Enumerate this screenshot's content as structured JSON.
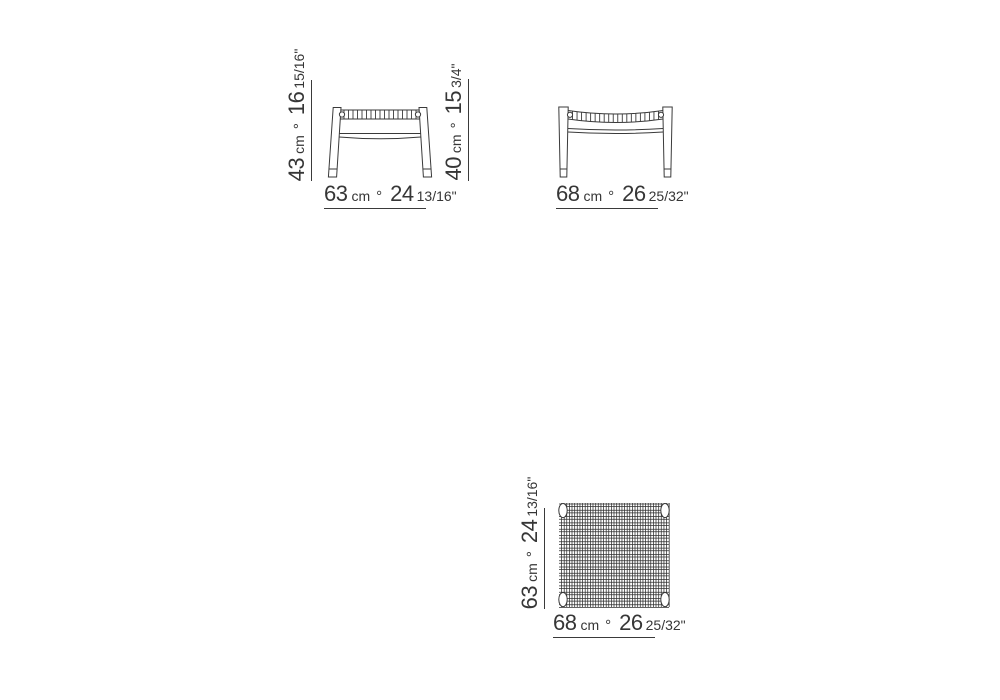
{
  "title": "stool-dimension-diagram",
  "unit": "cm",
  "sep": "°",
  "colors": {
    "line": "#3a3a3a",
    "text": "#363636",
    "background": "#ffffff"
  },
  "views": {
    "front": {
      "label": "front view",
      "height": {
        "cm": "43",
        "inches": "16",
        "fraction": "15/16\""
      },
      "width": {
        "cm": "63",
        "inches": "24",
        "fraction": "13/16\""
      }
    },
    "side": {
      "label": "side view",
      "height": {
        "cm": "40",
        "inches": "15",
        "fraction": "3/4\""
      },
      "width": {
        "cm": "68",
        "inches": "26",
        "fraction": "25/32\""
      }
    },
    "top": {
      "label": "top view",
      "depth": {
        "cm": "63",
        "inches": "24",
        "fraction": "13/16\""
      },
      "width": {
        "cm": "68",
        "inches": "26",
        "fraction": "25/32\""
      }
    }
  }
}
